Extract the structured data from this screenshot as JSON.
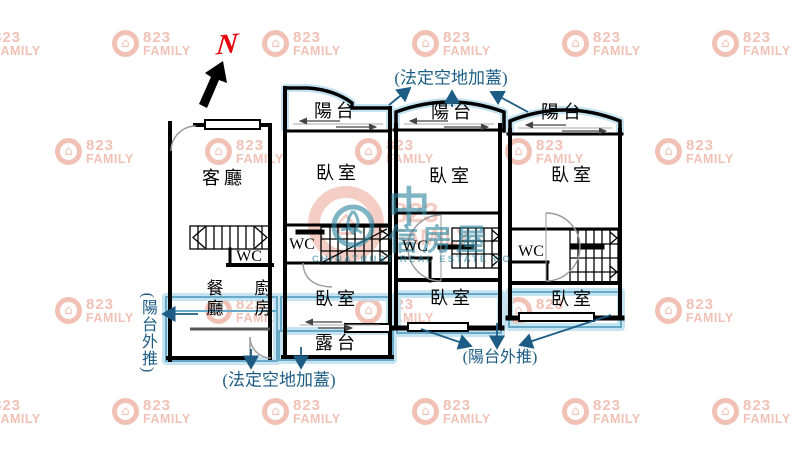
{
  "compass": {
    "north": "N"
  },
  "watermark": {
    "number": "823",
    "name": "FAMILY"
  },
  "brand_center": {
    "number": "823",
    "name": "FAMILY",
    "cjk_main": "中",
    "cjk_rest": "信房屋",
    "english": "CHINATRUST REAL ESTATE CO"
  },
  "annotations": {
    "top": "(法定空地加蓋)",
    "bottom": "(法定空地加蓋)",
    "left": "(陽台外推)",
    "right": "(陽台外推)"
  },
  "rooms": {
    "u1": {
      "living": "客廳",
      "wc": "WC",
      "dining": "餐廳",
      "kitchen": "廚房"
    },
    "u2": {
      "balcony": "陽台",
      "bed1": "臥室",
      "wc": "WC",
      "bed2": "臥室",
      "terrace": "露台"
    },
    "u3": {
      "balcony": "陽台",
      "bed1": "臥室",
      "wc": "WC",
      "bed2": "臥室"
    },
    "u4": {
      "balcony": "陽台",
      "bed1": "臥室",
      "wc": "WC",
      "bed2": "臥室"
    }
  },
  "colors": {
    "wall": "#000000",
    "annotation": "#1d5d85",
    "highlight_line": "#69a9c8",
    "highlight_glow": "#bfe1ef",
    "watermark_pink": "#e0765c",
    "logo_teal": "#2f86a0",
    "north_red": "#e8000d"
  }
}
